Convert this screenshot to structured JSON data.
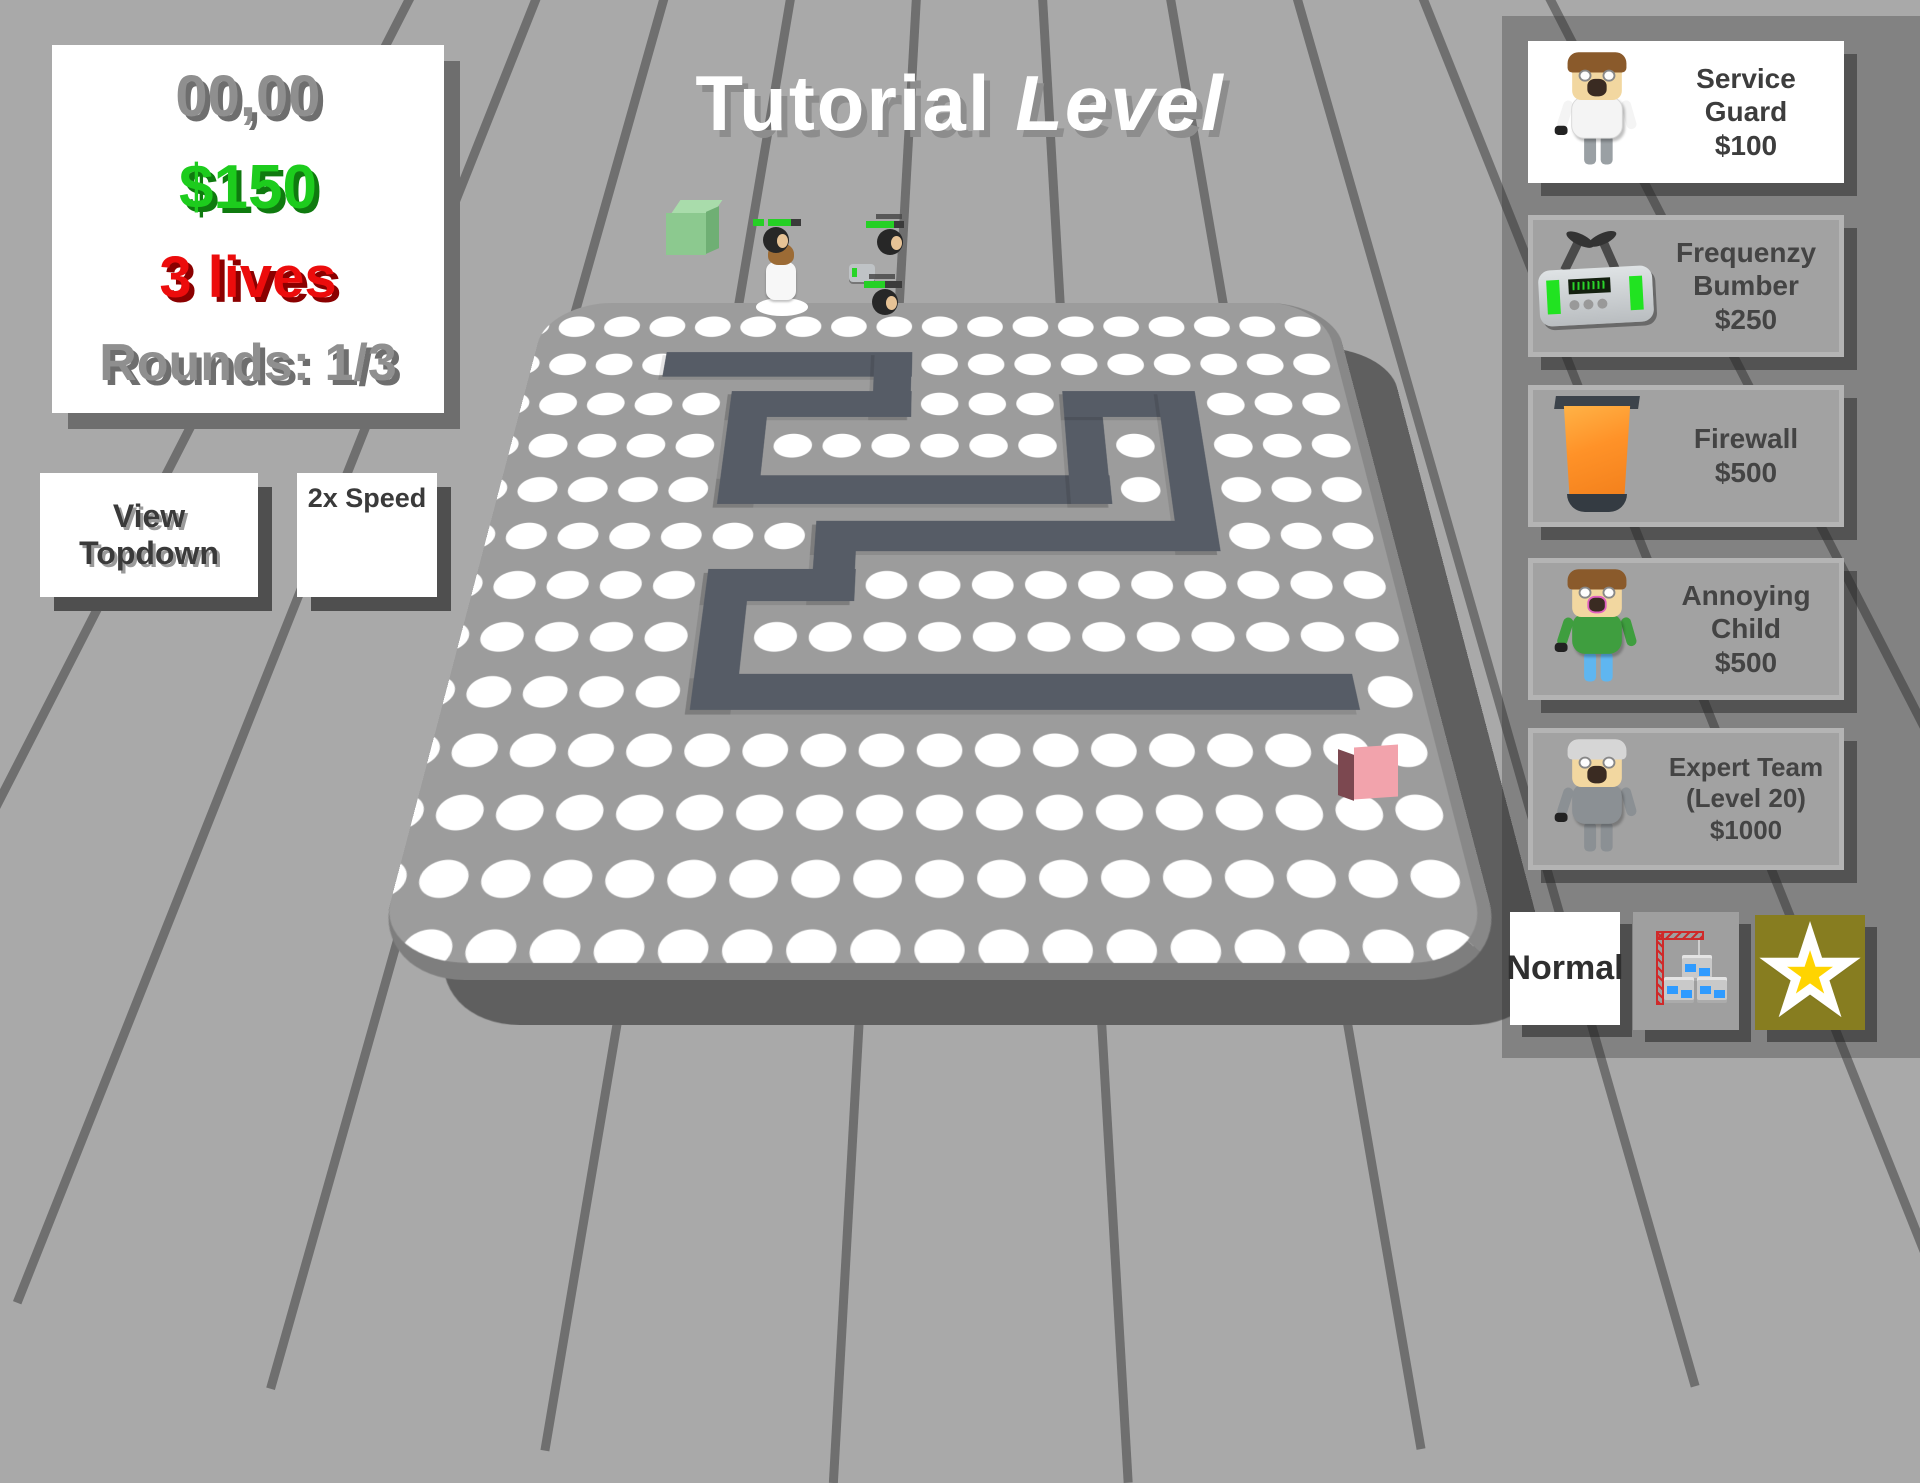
{
  "title": {
    "regular": "Tutorial ",
    "italic": "Level"
  },
  "hud": {
    "score": "00,00",
    "money": "$150",
    "lives": "3 lives",
    "rounds": "Rounds: 1/3"
  },
  "controls": {
    "view_topdown": "View Topdown",
    "speed": "2x Speed"
  },
  "shop": {
    "items": [
      {
        "name": "Service Guard",
        "price": "$100",
        "icon": "service-guard-figure"
      },
      {
        "name": "Frequenzy Bumber",
        "price": "$250",
        "icon": "frequenzy-bumber-device"
      },
      {
        "name": "Firewall",
        "price": "$500",
        "icon": "firewall-bin"
      },
      {
        "name": "Annoying Child",
        "price": "$500",
        "icon": "annoying-child-figure"
      },
      {
        "name": "Expert Team",
        "sub": "(Level 20)",
        "price": "$1000",
        "icon": "expert-team-figure"
      }
    ]
  },
  "footer": {
    "mode": "Normal",
    "build_icon": "crane-blocks-icon",
    "star_icon": "star-icon",
    "star_glyph": "★"
  },
  "level": {
    "start_marker": "green-start-cube",
    "end_marker": "pink-end-cube",
    "path_icon": "path-track"
  },
  "colors": {
    "money_green": "#1dcc1d",
    "lives_red": "#ec0c0c",
    "path_gray": "#565c66",
    "star_yellow": "#ffd400",
    "start_green": "#8cc98f",
    "end_pink": "#f2a3ac",
    "health_green": "#25d025"
  }
}
